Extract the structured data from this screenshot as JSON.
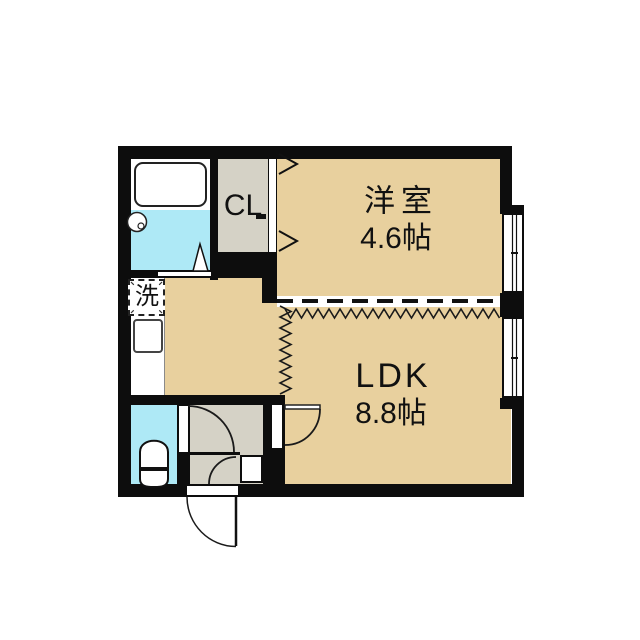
{
  "plan": {
    "rooms": [
      {
        "id": "youshitsu",
        "name": "洋室",
        "size": "4.6帖"
      },
      {
        "id": "ldk",
        "name": "LDK",
        "size": "8.8帖"
      }
    ],
    "closet_label": "CL",
    "laundry_label": "洗",
    "fixtures": [
      "bathtub",
      "washbasin",
      "toilet",
      "kitchen-sink",
      "washing-machine-space",
      "shoe-cabinet"
    ]
  },
  "colors": {
    "room": "#e8d09e",
    "service": "#d5d2c6",
    "water": "#aee9f6",
    "wall": "#0d0d0d",
    "line": "#1a1a1a",
    "background": "#ffffff"
  }
}
